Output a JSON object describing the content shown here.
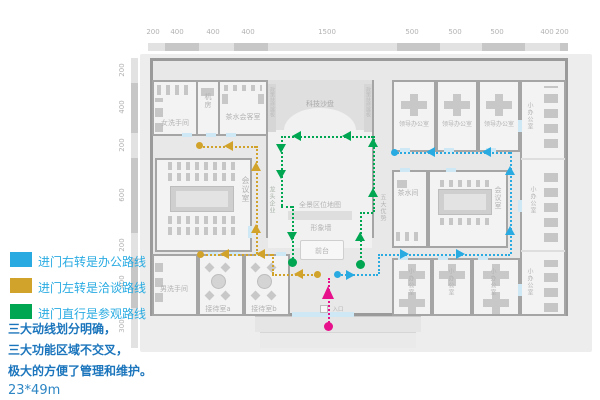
{
  "colors": {
    "office_route": "#29abe2",
    "talk_route": "#d2a32b",
    "visit_route": "#00a651",
    "entrance_route": "#e6118b"
  },
  "rulers": {
    "top": [
      "200",
      "400",
      "400",
      "400",
      "1500",
      "500",
      "500",
      "500",
      "400",
      "200"
    ],
    "left": [
      "200",
      "400",
      "200",
      "600",
      "200",
      "400",
      "300"
    ],
    "right": [
      "200",
      "400",
      "200",
      "600",
      "200",
      "400",
      "300"
    ]
  },
  "rooms": {
    "women_restroom": "女洗手间",
    "machine_room": "机房",
    "tea_reception": "茶水会客室",
    "tech_sandbox": "科技沙盘",
    "policy_board": "政策扶持展板",
    "meeting_room": "会议室",
    "panorama_map": "全景区位地图",
    "image_wall": "形象墙",
    "front_desk": "前台",
    "five_advantages": "五大优势",
    "leading_enterprise": "龙头企业",
    "men_restroom": "男洗手间",
    "reception_a": "接待室a",
    "reception_b": "接待室b",
    "leader_office": "领导办公室",
    "small_office": "小办公室",
    "tea_room": "茶水间",
    "entrance": "入口"
  },
  "legend": {
    "items": [
      {
        "label": "进门右转是办公路线"
      },
      {
        "label": "进门左转是洽谈路线"
      },
      {
        "label": "进门直行是参观路线"
      }
    ],
    "note_line1": "三大动线划分明确，",
    "note_line2": "三大功能区域不交叉，",
    "note_line3": "极大的方便了管理和维护。",
    "size": "23*49m"
  }
}
